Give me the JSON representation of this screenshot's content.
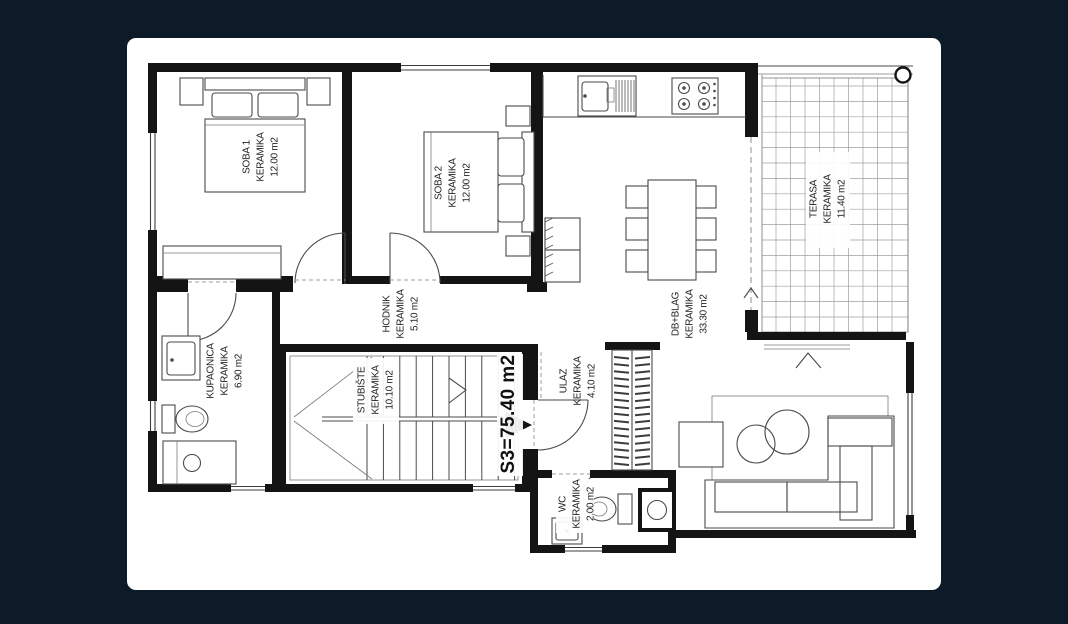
{
  "colors": {
    "background": "#0d1b28",
    "paper": "#ffffff",
    "wall": "#141414"
  },
  "plan": {
    "unit_area_label": "S3=75.40 m2",
    "rooms": [
      {
        "name": "SOBA 1",
        "finish": "KERAMIKA",
        "area": "12.00 m2"
      },
      {
        "name": "SOBA 2",
        "finish": "KERAMIKA",
        "area": "12.00 m2"
      },
      {
        "name": "HODNIK",
        "finish": "KERAMIKA",
        "area": "5.10 m2"
      },
      {
        "name": "KUPAONICA",
        "finish": "KERAMIKA",
        "area": "6.90 m2"
      },
      {
        "name": "STUBIŠTE",
        "finish": "KERAMIKA",
        "area": "10.10 m2"
      },
      {
        "name": "ULAZ",
        "finish": "KERAMIKA",
        "area": "4.10 m2"
      },
      {
        "name": "WC",
        "finish": "KERAMIKA",
        "area": "2.00 m2"
      },
      {
        "name": "DB+BLAG",
        "finish": "KERAMIKA",
        "area": "33.30 m2"
      },
      {
        "name": "TERASA",
        "finish": "KERAMIKA",
        "area": "11.40 m2"
      }
    ]
  }
}
